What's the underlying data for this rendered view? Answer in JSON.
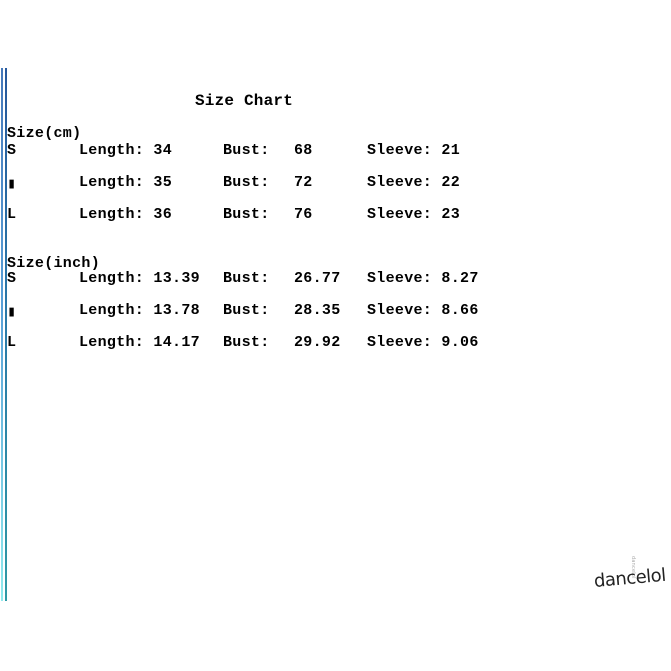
{
  "title": "Size Chart",
  "sections": [
    {
      "heading": "Size(cm)",
      "rows": [
        {
          "size": "S",
          "length": "Length: 34",
          "bust_label": "Bust:",
          "bust_value": "68",
          "sleeve": "Sleeve: 21"
        },
        {
          "size": "▮",
          "length": "Length: 35",
          "bust_label": "Bust:",
          "bust_value": "72",
          "sleeve": "Sleeve: 22"
        },
        {
          "size": "L",
          "length": "Length: 36",
          "bust_label": "Bust:",
          "bust_value": "76",
          "sleeve": "Sleeve: 23"
        }
      ]
    },
    {
      "heading": "Size(inch)",
      "rows": [
        {
          "size": "S",
          "length": "Length: 13.39",
          "bust_label": "Bust:",
          "bust_value": "26.77",
          "sleeve": "Sleeve: 8.27"
        },
        {
          "size": "▮",
          "length": "Length: 13.78",
          "bust_label": "Bust:",
          "bust_value": "28.35",
          "sleeve": "Sleeve: 8.66"
        },
        {
          "size": "L",
          "length": "Length: 14.17",
          "bust_label": "Bust:",
          "bust_value": "29.92",
          "sleeve": "Sleeve: 9.06"
        }
      ]
    }
  ],
  "watermark": {
    "text": "dancelol",
    "vertical_text": "dancelol"
  },
  "colors": {
    "background": "#ffffff",
    "text": "#000000",
    "edge_line_light_top": "#4578ba",
    "edge_line_light_bottom": "#8feaee",
    "edge_line_dark_top": "#27589c",
    "edge_line_dark_bottom": "#2e9aa6",
    "watermark": "#222222",
    "watermark_small": "#ababab"
  }
}
